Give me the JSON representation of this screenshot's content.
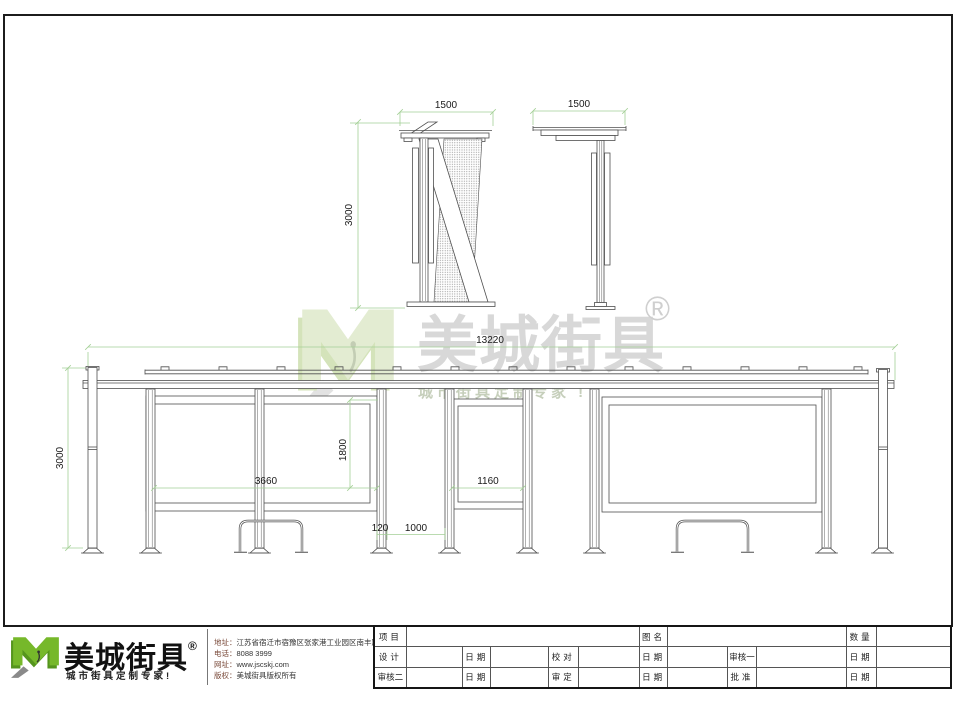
{
  "watermark": {
    "brand": "美城街具",
    "registered": "®",
    "tagline": "城市街具定制专家 !"
  },
  "dimensions": {
    "side_a_width": "1500",
    "side_a_height": "3000",
    "side_b_width": "1500",
    "total_width": "13220",
    "total_height": "3000",
    "panel_width": "3660",
    "panel_height": "1800",
    "mid_panel_width": "1160",
    "post_width": "120",
    "post_gap": "1000"
  },
  "footer": {
    "brand": "美城街具",
    "registered": "®",
    "tagline": "城市街具定制专家!",
    "contact": {
      "address_label": "地址：",
      "address": "江苏省宿迁市宿豫区张家港工业园区南丰路西侧1号",
      "phone_label": "电话：",
      "phone": "8088 3999",
      "website_label": "网址：",
      "website": "www.jscskj.com",
      "copyright_label": "版权：",
      "copyright": "美城街具版权所有"
    },
    "titleblock": {
      "project": "项目",
      "drawing_name": "图名",
      "quantity": "数量",
      "design": "设计",
      "check": "校对",
      "review1": "审核一",
      "review2": "审核二",
      "approve_final": "审定",
      "approve": "批准",
      "date": "日期"
    }
  },
  "colors": {
    "line": "#4f4f4f",
    "dim_green": "#a3cf96",
    "logo_green": "#76b82a",
    "logo_green_dark": "#55951d",
    "watermark_gray": "#d8d8d8"
  }
}
